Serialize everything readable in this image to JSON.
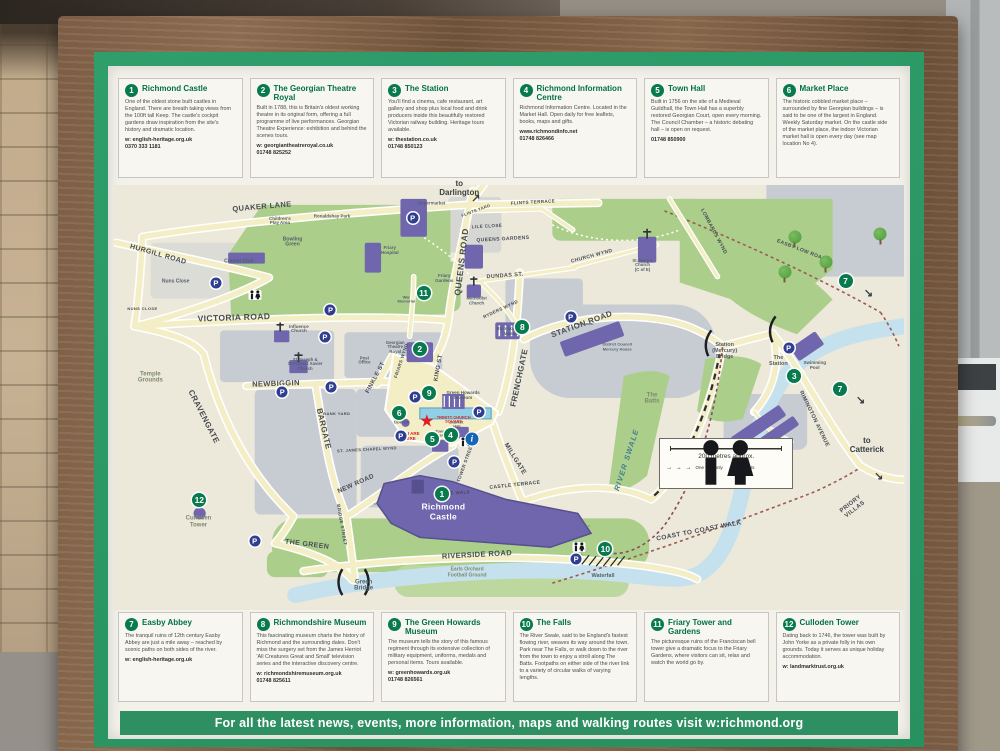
{
  "board": {
    "footer": "For all the latest news, events, more information, maps and walking routes visit w:richmond.org"
  },
  "boxes": [
    {
      "n": "1",
      "title": "Richmond Castle",
      "body": "One of the oldest stone built castles in England. There are breath taking views from the 100ft tall Keep. The castle's cockpit gardens draw inspiration from the site's history and dramatic location.",
      "web": "w: english-heritage.org.uk",
      "phone": "0370 333 1181"
    },
    {
      "n": "2",
      "title": "The Georgian Theatre Royal",
      "body": "Built in 1788, this is Britain's oldest working theatre in its original form, offering a full programme of live performances. Georgian Theatre Experience: exhibition and behind the scenes tours.",
      "web": "w: georgiantheatreroyal.co.uk",
      "phone": "01748 825252"
    },
    {
      "n": "3",
      "title": "The Station",
      "body": "You'll find a cinema, cafe restaurant, art gallery and shop plus local food and drink producers inside this beautifully restored Victorian railway building. Heritage tours available.",
      "web": "w: thestation.co.uk",
      "phone": "01748 850123"
    },
    {
      "n": "4",
      "title": "Richmond Information Centre",
      "body": "Richmond Information Centre. Located in the Market Hall. Open daily for free leaflets, books, maps and gifts.",
      "web": "www.richmondinfo.net",
      "phone": "01748 826466"
    },
    {
      "n": "5",
      "title": "Town Hall",
      "body": "Built in 1756 on the site of a Medieval Guildhall, the Town Hall has a superbly restored Georgian Court, open every morning. The Council Chamber – a historic debating hall – is open on request.",
      "web": "",
      "phone": "01748 850900"
    },
    {
      "n": "6",
      "title": "Market Place",
      "body": "The historic cobbled market place – surrounded by fine Georgian buildings – is said to be one of the largest in England. Weekly Saturday market. On the castle side of the market place, the indoor Victorian market hall is open every day (see map location No 4).",
      "web": "",
      "phone": ""
    },
    {
      "n": "7",
      "title": "Easby Abbey",
      "body": "The tranquil ruins of 12th century Easby Abbey are just a mile away – reached by scenic paths on both sides of the river.",
      "web": "w: english-heritage.org.uk",
      "phone": ""
    },
    {
      "n": "8",
      "title": "Richmondshire Museum",
      "body": "This fascinating museum charts the history of Richmond and the surrounding dales. Don't miss the surgery set from the James Herriot 'All Creatures Great and Small' television series and the interactive discovery centre.",
      "web": "w: richmondshiremuseum.org.uk",
      "phone": "01748 825611"
    },
    {
      "n": "9",
      "title": "The Green Howards Museum",
      "body": "The museum tells the story of this famous regiment through its extensive collection of military equipment, uniforms, medals and personal items. Tours available.",
      "web": "w: greenhowards.org.uk",
      "phone": "01748 826561"
    },
    {
      "n": "10",
      "title": "The Falls",
      "body": "The River Swale, said to be England's fastest flowing river, weaves its way around the town. Park near The Falls, or walk down to the river from the town to enjoy a stroll along The Batts. Footpaths on either side of the river link to a variety of circular walks of varying lengths.",
      "web": "",
      "phone": ""
    },
    {
      "n": "11",
      "title": "Friary Tower and Gardens",
      "body": "The picturesque ruins of the Franciscan bell tower give a dramatic focus to the Friary Gardens, where visitors can sit, relax and watch the world go by.",
      "web": "",
      "phone": ""
    },
    {
      "n": "12",
      "title": "Culloden Tower",
      "body": "Dating back to 1746, the tower was built by John Yorke as a private folly in his own grounds. Today it serves as unique holiday accommodation.",
      "web": "w: landmarktrust.org.uk",
      "phone": ""
    }
  ],
  "map": {
    "legend": {
      "scale_label": "200 metres approx.",
      "one_way_label": "One way only",
      "toilets_label": "Toilets"
    },
    "labels": [
      {
        "t": "QUAKER LANE",
        "x": 18.7,
        "y": 5.2,
        "r": -5,
        "s": 7.5
      },
      {
        "t": "HURGILL ROAD",
        "x": 5.6,
        "y": 16.5,
        "r": 16,
        "s": 7
      },
      {
        "t": "VICTORIA ROAD",
        "x": 15.2,
        "y": 31.2,
        "r": -2,
        "s": 8.5
      },
      {
        "t": "QUEENS ROAD",
        "x": 44.0,
        "y": 18.0,
        "r": -83,
        "s": 8.5
      },
      {
        "t": "FRENCHGATE",
        "x": 51.4,
        "y": 45.5,
        "r": -78,
        "s": 8
      },
      {
        "t": "STATION ROAD",
        "x": 59.2,
        "y": 33.0,
        "r": -20,
        "s": 8
      },
      {
        "t": "DUNDAS ST.",
        "x": 49.5,
        "y": 21.5,
        "r": -4,
        "s": 5.5
      },
      {
        "t": "CHURCH WYND",
        "x": 60.5,
        "y": 17.0,
        "r": -15,
        "s": 5
      },
      {
        "t": "LOMBARDS WYND",
        "x": 75.8,
        "y": 11.0,
        "r": 62,
        "s": 5
      },
      {
        "t": "EASBY LOW ROAD",
        "x": 87.0,
        "y": 15.5,
        "r": 21,
        "s": 5
      },
      {
        "t": "NEWBIGGIN",
        "x": 20.5,
        "y": 46.8,
        "r": -2,
        "s": 7.5
      },
      {
        "t": "CRAVENGATE",
        "x": 11.3,
        "y": 54.5,
        "r": 63,
        "s": 8
      },
      {
        "t": "BARGATE",
        "x": 26.4,
        "y": 57.5,
        "r": 77,
        "s": 8
      },
      {
        "t": "FINKLE ST",
        "x": 33.2,
        "y": 45.5,
        "r": -62,
        "s": 6
      },
      {
        "t": "KING ST",
        "x": 41.2,
        "y": 43.0,
        "r": -80,
        "s": 6
      },
      {
        "t": "FRIARS WYND",
        "x": 36.5,
        "y": 41.5,
        "r": -72,
        "s": 4.5
      },
      {
        "t": "RYDERS WYND",
        "x": 49.0,
        "y": 29.5,
        "r": -25,
        "s": 4.5
      },
      {
        "t": "MILLGATE",
        "x": 50.8,
        "y": 64.5,
        "r": 58,
        "s": 6.5
      },
      {
        "t": "NEW ROAD",
        "x": 30.6,
        "y": 70.3,
        "r": -24,
        "s": 6.5
      },
      {
        "t": "TOWER STREET",
        "x": 44.6,
        "y": 65.5,
        "r": -70,
        "s": 4.5
      },
      {
        "t": "BRIDGE STREET",
        "x": 28.7,
        "y": 80.0,
        "r": 80,
        "s": 4.5
      },
      {
        "t": "THE GREEN",
        "x": 24.4,
        "y": 84.8,
        "r": 7,
        "s": 7
      },
      {
        "t": "RIVERSIDE ROAD",
        "x": 46.0,
        "y": 87.0,
        "r": -3,
        "s": 7.5
      },
      {
        "t": "CASTLE TERRACE",
        "x": 50.8,
        "y": 70.8,
        "r": -6,
        "s": 5
      },
      {
        "t": "CASTLE WALK",
        "x": 42.8,
        "y": 72.6,
        "r": -4,
        "s": 4.5
      },
      {
        "t": "RIMINGTON AVENUE",
        "x": 88.6,
        "y": 55.0,
        "r": 64,
        "s": 5.5
      },
      {
        "t": "COAST TO COAST WALK",
        "x": 74.0,
        "y": 81.3,
        "r": -11,
        "s": 6.5
      },
      {
        "t": "PRIORY VILLAS",
        "x": 93.6,
        "y": 75.8,
        "r": -38,
        "s": 6
      },
      {
        "t": "ST. JAMES CHAPEL WYND",
        "x": 32.0,
        "y": 62.3,
        "r": -3,
        "s": 4
      },
      {
        "t": "FLINTS TERRACE",
        "x": 53.0,
        "y": 4.2,
        "r": -3,
        "s": 4.5
      },
      {
        "t": "FLINTS YARD",
        "x": 45.8,
        "y": 6.0,
        "r": -20,
        "s": 4
      },
      {
        "t": "QUEENS GARDENS",
        "x": 49.3,
        "y": 13.0,
        "r": -3,
        "s": 5
      },
      {
        "t": "LILE CLOSE",
        "x": 47.2,
        "y": 9.8,
        "r": -3,
        "s": 4.5
      },
      {
        "t": "NUNS CLOSE",
        "x": 3.6,
        "y": 29.2,
        "r": 0,
        "s": 4
      },
      {
        "t": "BANK YARD",
        "x": 28.2,
        "y": 53.8,
        "r": 0,
        "s": 4
      },
      {
        "t": "Nuns Close",
        "x": 7.8,
        "y": 22.8,
        "k": "pl",
        "s": 5
      },
      {
        "t": "Cricket Club",
        "x": 15.8,
        "y": 18.0,
        "k": "pl",
        "s": 5
      },
      {
        "t": "Bowling\nGreen",
        "x": 22.6,
        "y": 13.6,
        "k": "pl",
        "s": 5
      },
      {
        "t": "Children's\nPlay Area",
        "x": 21.0,
        "y": 8.6,
        "k": "pl",
        "s": 4.5
      },
      {
        "t": "Ronaldshay Park",
        "x": 27.6,
        "y": 7.6,
        "k": "pl",
        "s": 4.5
      },
      {
        "t": "Supermarket",
        "x": 40.2,
        "y": 4.4,
        "k": "pl",
        "s": 4.5
      },
      {
        "t": "Friary\nHospital",
        "x": 34.9,
        "y": 15.6,
        "k": "pl",
        "s": 4.5
      },
      {
        "t": "Friary\nGardens",
        "x": 41.8,
        "y": 22.2,
        "k": "pl",
        "s": 4.5
      },
      {
        "t": "War\nMemorial",
        "x": 37.0,
        "y": 27.0,
        "k": "pl",
        "s": 4
      },
      {
        "t": "Influence\nChurch",
        "x": 23.4,
        "y": 34.0,
        "k": "pl",
        "s": 4.5
      },
      {
        "t": "St Joseph &\nSt Francis Xavier\nChurch",
        "x": 24.2,
        "y": 42.3,
        "k": "pl",
        "s": 4.3
      },
      {
        "t": "Georgian\nTheatre\nRoyal",
        "x": 35.6,
        "y": 38.3,
        "k": "pl",
        "s": 4.3
      },
      {
        "t": "Post\nOffice",
        "x": 31.7,
        "y": 41.3,
        "k": "pl",
        "s": 4.3
      },
      {
        "t": "Methodist\nChurch",
        "x": 45.9,
        "y": 27.4,
        "k": "pl",
        "s": 4.3
      },
      {
        "t": "Richmondshire\nMuseum",
        "x": 50.5,
        "y": 34.6,
        "k": "pl",
        "s": 4.5
      },
      {
        "t": "St. Mary's\nChurch\n(C of E)",
        "x": 66.9,
        "y": 19.0,
        "k": "pl",
        "s": 4.3
      },
      {
        "t": "weekends",
        "x": 59.4,
        "y": 32.8,
        "k": "pl",
        "s": 4
      },
      {
        "t": "District Council\nMercury House",
        "x": 63.7,
        "y": 38.2,
        "k": "pl",
        "s": 4
      },
      {
        "t": "Green Howards\nMuseum",
        "x": 44.2,
        "y": 49.6,
        "k": "pl",
        "s": 4.5
      },
      {
        "t": "Obelisk",
        "x": 36.4,
        "y": 56.0,
        "k": "pl",
        "s": 4.3
      },
      {
        "t": "Town\nHall",
        "x": 41.3,
        "y": 58.6,
        "k": "pl",
        "s": 4
      },
      {
        "t": "Market\nHall",
        "x": 43.4,
        "y": 56.4,
        "k": "pl",
        "s": 4
      },
      {
        "t": "Station\n(Mercury)\nBridge",
        "x": 77.3,
        "y": 39.0,
        "k": "pl",
        "s": 5.5
      },
      {
        "t": "The\nStation",
        "x": 84.1,
        "y": 41.3,
        "k": "pl",
        "s": 5.5
      },
      {
        "t": "Swimming\nPool",
        "x": 88.7,
        "y": 42.7,
        "k": "pl",
        "s": 4.5
      },
      {
        "t": "Green\nBridge",
        "x": 31.6,
        "y": 94.3,
        "k": "pl",
        "s": 6
      },
      {
        "t": "Waterfall",
        "x": 61.9,
        "y": 92.0,
        "k": "pl",
        "s": 5.5
      },
      {
        "t": "Temple\nGrounds",
        "x": 4.6,
        "y": 45.3,
        "k": "ar",
        "s": 6
      },
      {
        "t": "Culloden\nTower",
        "x": 10.7,
        "y": 79.3,
        "k": "ar",
        "s": 6
      },
      {
        "t": "Earls Orchard\nFootball Ground",
        "x": 44.7,
        "y": 91.3,
        "k": "ar",
        "s": 5
      },
      {
        "t": "The\nBatts",
        "x": 68.1,
        "y": 50.3,
        "k": "ar",
        "s": 6
      },
      {
        "t": "RIVER SWALE",
        "x": 64.9,
        "y": 64.8,
        "r": -72,
        "k": "wa",
        "s": 7.5
      },
      {
        "t": "to\nDarlington",
        "x": 43.7,
        "y": 1.0,
        "k": "dest",
        "s": 8
      },
      {
        "t": "to\nCatterick",
        "x": 95.3,
        "y": 61.5,
        "k": "dest",
        "s": 8
      },
      {
        "t": "Richmond\nCastle",
        "x": 41.7,
        "y": 77.0,
        "k": "ca",
        "s": 8.5
      },
      {
        "t": "TRINITY CHURCH\nSQUARE",
        "x": 43.0,
        "y": 55.2,
        "k": "red",
        "s": 4
      },
      {
        "t": "YOU ARE\nHERE",
        "x": 37.4,
        "y": 59.2,
        "k": "red",
        "s": 4.5
      }
    ],
    "badges": [
      {
        "n": "1",
        "x": 41.5,
        "y": 72.6
      },
      {
        "n": "2",
        "x": 38.7,
        "y": 38.6
      },
      {
        "n": "3",
        "x": 86.1,
        "y": 45.0
      },
      {
        "n": "4",
        "x": 42.6,
        "y": 58.8
      },
      {
        "n": "5",
        "x": 40.3,
        "y": 59.7
      },
      {
        "n": "6",
        "x": 36.1,
        "y": 53.6
      },
      {
        "n": "7",
        "x": 92.6,
        "y": 22.7
      },
      {
        "n": "7",
        "x": 91.9,
        "y": 48.0
      },
      {
        "n": "8",
        "x": 51.7,
        "y": 33.5
      },
      {
        "n": "9",
        "x": 39.9,
        "y": 48.9
      },
      {
        "n": "10",
        "x": 62.2,
        "y": 85.7
      },
      {
        "n": "11",
        "x": 39.2,
        "y": 25.3
      },
      {
        "n": "12",
        "x": 10.8,
        "y": 74.2
      }
    ],
    "icons": [
      {
        "t": "parking",
        "x": 12.9,
        "y": 23.0
      },
      {
        "t": "parking",
        "x": 37.8,
        "y": 7.7
      },
      {
        "t": "parking",
        "x": 27.4,
        "y": 29.5
      },
      {
        "t": "parking",
        "x": 26.7,
        "y": 35.8
      },
      {
        "t": "parking",
        "x": 21.3,
        "y": 48.7
      },
      {
        "t": "parking",
        "x": 27.5,
        "y": 47.5
      },
      {
        "t": "parking",
        "x": 36.3,
        "y": 59.0
      },
      {
        "t": "parking",
        "x": 38.1,
        "y": 49.9
      },
      {
        "t": "parking",
        "x": 46.2,
        "y": 53.4
      },
      {
        "t": "parking",
        "x": 43.1,
        "y": 65.1
      },
      {
        "t": "parking",
        "x": 57.8,
        "y": 31.1
      },
      {
        "t": "parking",
        "x": 17.8,
        "y": 83.8
      },
      {
        "t": "parking",
        "x": 85.4,
        "y": 38.4
      },
      {
        "t": "parking",
        "x": 58.5,
        "y": 88.1
      },
      {
        "t": "toilets",
        "x": 17.8,
        "y": 25.8
      },
      {
        "t": "toilets",
        "x": 58.8,
        "y": 85.2
      },
      {
        "t": "toilets",
        "x": 44.6,
        "y": 60.4
      },
      {
        "t": "info",
        "x": 45.3,
        "y": 59.7
      },
      {
        "t": "star",
        "x": 39.6,
        "y": 55.5
      },
      {
        "t": "tree",
        "x": 86.2,
        "y": 12.2
      },
      {
        "t": "tree",
        "x": 90.1,
        "y": 18.0
      },
      {
        "t": "tree",
        "x": 84.9,
        "y": 20.4
      },
      {
        "t": "tree",
        "x": 97.0,
        "y": 11.5
      },
      {
        "t": "arrow",
        "g": "↗",
        "x": 45.8,
        "y": 3.0
      },
      {
        "t": "arrow",
        "g": "↘",
        "x": 96.8,
        "y": 68.5
      },
      {
        "t": "arrow",
        "g": "↘",
        "x": 95.5,
        "y": 25.5
      },
      {
        "t": "arrow",
        "g": "↘",
        "x": 94.5,
        "y": 50.5
      }
    ]
  },
  "colors": {
    "mat_green": "#2f9e6b",
    "footer_green": "#2e8f63",
    "badge_green": "#087a4e",
    "title_green": "#00704a",
    "landmark_purple": "#6f66ad",
    "road_cream": "#f3eec6",
    "park_green": "#abcf8b",
    "river_blue": "#c6e1ee",
    "alert_red": "#d2232a",
    "parking_blue": "#2f3e8f",
    "info_blue": "#1565b5"
  }
}
